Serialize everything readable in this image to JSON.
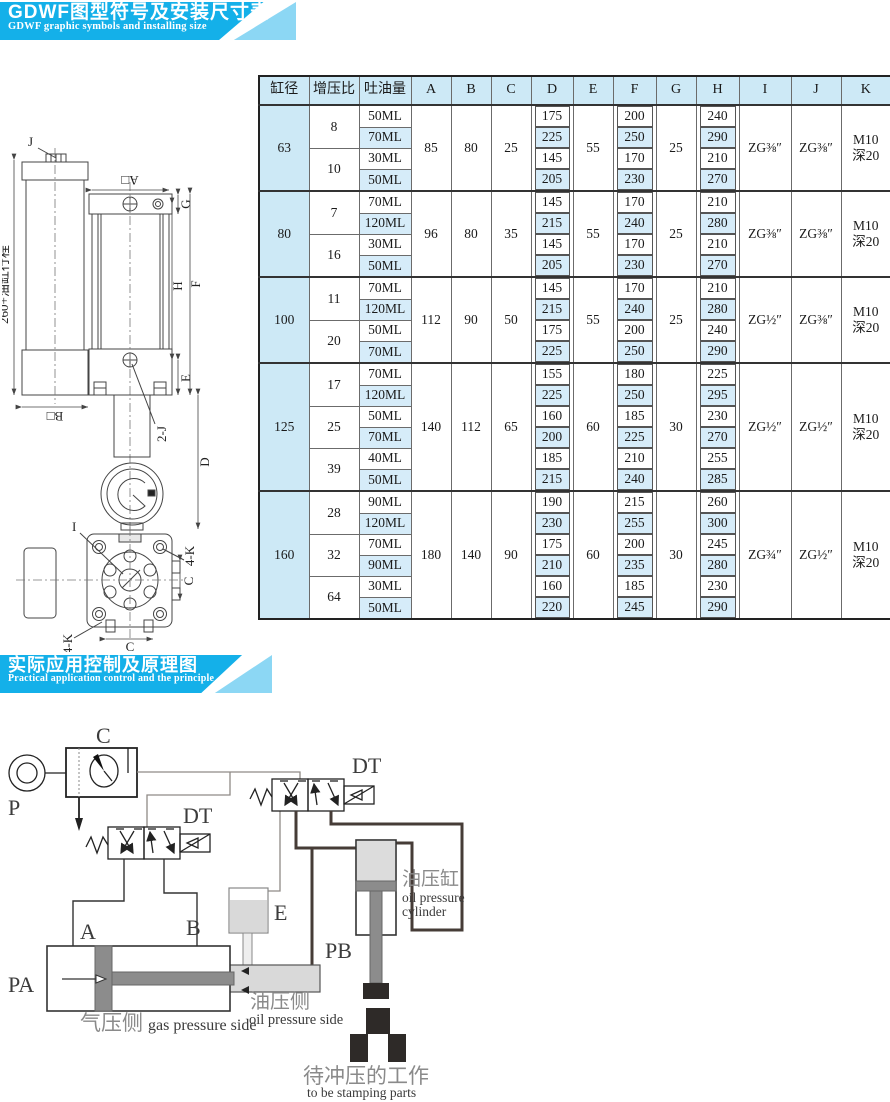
{
  "banner1": {
    "title": "GDWF图型符号及安装尺寸表",
    "subtitle": "GDWF graphic symbols and installing size"
  },
  "banner2": {
    "title": "实际应用控制及原理图",
    "subtitle": "Practical application control and the principle"
  },
  "colors": {
    "banner_cyan": "#14b0e9",
    "banner_light": "#8cd7f4",
    "header_blue": "#cde9f6",
    "row_alt_blue": "#d6ecf9"
  },
  "drawing": {
    "labels": {
      "j": "J",
      "a_dim": "A□",
      "b_dim": "B□",
      "g": "G",
      "h": "H",
      "f": "F",
      "e": "E",
      "two_j": "2-J",
      "d": "D",
      "stroke_note": "260+油缸行程",
      "i": "I",
      "four_k_top": "4-K",
      "four_k_bottom": "4-K",
      "c_side": "C",
      "c_bottom": "C"
    }
  },
  "table": {
    "headers": [
      "缸径",
      "增压比",
      "吐油量",
      "A",
      "B",
      "C",
      "D",
      "E",
      "F",
      "G",
      "H",
      "I",
      "J",
      "K"
    ],
    "groups": [
      {
        "bore": "63",
        "a": "85",
        "b": "80",
        "c": "25",
        "e": "55",
        "g": "25",
        "i": "ZG⅜″",
        "j": "ZG⅜″",
        "k1": "M10",
        "k2": "深20",
        "ratios": [
          {
            "ratio": "8",
            "rows": [
              {
                "ml": "50ML",
                "d": "175",
                "f": "200",
                "h": "240"
              },
              {
                "ml": "70ML",
                "d": "225",
                "f": "250",
                "h": "290"
              }
            ]
          },
          {
            "ratio": "10",
            "rows": [
              {
                "ml": "30ML",
                "d": "145",
                "f": "170",
                "h": "210"
              },
              {
                "ml": "50ML",
                "d": "205",
                "f": "230",
                "h": "270"
              }
            ]
          }
        ]
      },
      {
        "bore": "80",
        "a": "96",
        "b": "80",
        "c": "35",
        "e": "55",
        "g": "25",
        "i": "ZG⅜″",
        "j": "ZG⅜″",
        "k1": "M10",
        "k2": "深20",
        "ratios": [
          {
            "ratio": "7",
            "rows": [
              {
                "ml": "70ML",
                "d": "145",
                "f": "170",
                "h": "210"
              },
              {
                "ml": "120ML",
                "d": "215",
                "f": "240",
                "h": "280"
              }
            ]
          },
          {
            "ratio": "16",
            "rows": [
              {
                "ml": "30ML",
                "d": "145",
                "f": "170",
                "h": "210"
              },
              {
                "ml": "50ML",
                "d": "205",
                "f": "230",
                "h": "270"
              }
            ]
          }
        ]
      },
      {
        "bore": "100",
        "a": "112",
        "b": "90",
        "c": "50",
        "e": "55",
        "g": "25",
        "i": "ZG½″",
        "j": "ZG⅜″",
        "k1": "M10",
        "k2": "深20",
        "ratios": [
          {
            "ratio": "11",
            "rows": [
              {
                "ml": "70ML",
                "d": "145",
                "f": "170",
                "h": "210"
              },
              {
                "ml": "120ML",
                "d": "215",
                "f": "240",
                "h": "280"
              }
            ]
          },
          {
            "ratio": "20",
            "rows": [
              {
                "ml": "50ML",
                "d": "175",
                "f": "200",
                "h": "240"
              },
              {
                "ml": "70ML",
                "d": "225",
                "f": "250",
                "h": "290"
              }
            ]
          }
        ]
      },
      {
        "bore": "125",
        "a": "140",
        "b": "112",
        "c": "65",
        "e": "60",
        "g": "30",
        "i": "ZG½″",
        "j": "ZG½″",
        "k1": "M10",
        "k2": "深20",
        "ratios": [
          {
            "ratio": "17",
            "rows": [
              {
                "ml": "70ML",
                "d": "155",
                "f": "180",
                "h": "225"
              },
              {
                "ml": "120ML",
                "d": "225",
                "f": "250",
                "h": "295"
              }
            ]
          },
          {
            "ratio": "25",
            "rows": [
              {
                "ml": "50ML",
                "d": "160",
                "f": "185",
                "h": "230"
              },
              {
                "ml": "70ML",
                "d": "200",
                "f": "225",
                "h": "270"
              }
            ]
          },
          {
            "ratio": "39",
            "rows": [
              {
                "ml": "40ML",
                "d": "185",
                "f": "210",
                "h": "255"
              },
              {
                "ml": "50ML",
                "d": "215",
                "f": "240",
                "h": "285"
              }
            ]
          }
        ]
      },
      {
        "bore": "160",
        "a": "180",
        "b": "140",
        "c": "90",
        "e": "60",
        "g": "30",
        "i": "ZG¾″",
        "j": "ZG½″",
        "k1": "M10",
        "k2": "深20",
        "ratios": [
          {
            "ratio": "28",
            "rows": [
              {
                "ml": "90ML",
                "d": "190",
                "f": "215",
                "h": "260"
              },
              {
                "ml": "120ML",
                "d": "230",
                "f": "255",
                "h": "300"
              }
            ]
          },
          {
            "ratio": "32",
            "rows": [
              {
                "ml": "70ML",
                "d": "175",
                "f": "200",
                "h": "245"
              },
              {
                "ml": "90ML",
                "d": "210",
                "f": "235",
                "h": "280"
              }
            ]
          },
          {
            "ratio": "64",
            "rows": [
              {
                "ml": "30ML",
                "d": "160",
                "f": "185",
                "h": "230"
              },
              {
                "ml": "50ML",
                "d": "220",
                "f": "245",
                "h": "290"
              }
            ]
          }
        ]
      }
    ]
  },
  "circuit": {
    "labels": {
      "p": "P",
      "c": "C",
      "dt1": "DT",
      "dt2": "DT",
      "a": "A",
      "b": "B",
      "e": "E",
      "pa": "PA",
      "pb": "PB",
      "oil_cylinder_cn": "油压缸",
      "oil_cylinder_en1": "oil pressure",
      "oil_cylinder_en2": "cylinder",
      "gas_side_cn": "气压侧",
      "gas_side_en": "gas pressure side",
      "oil_side_cn": "油压侧",
      "oil_side_en": "oil pressure side",
      "workpiece_cn": "待冲压的工作",
      "workpiece_en": "to be stamping parts"
    }
  }
}
